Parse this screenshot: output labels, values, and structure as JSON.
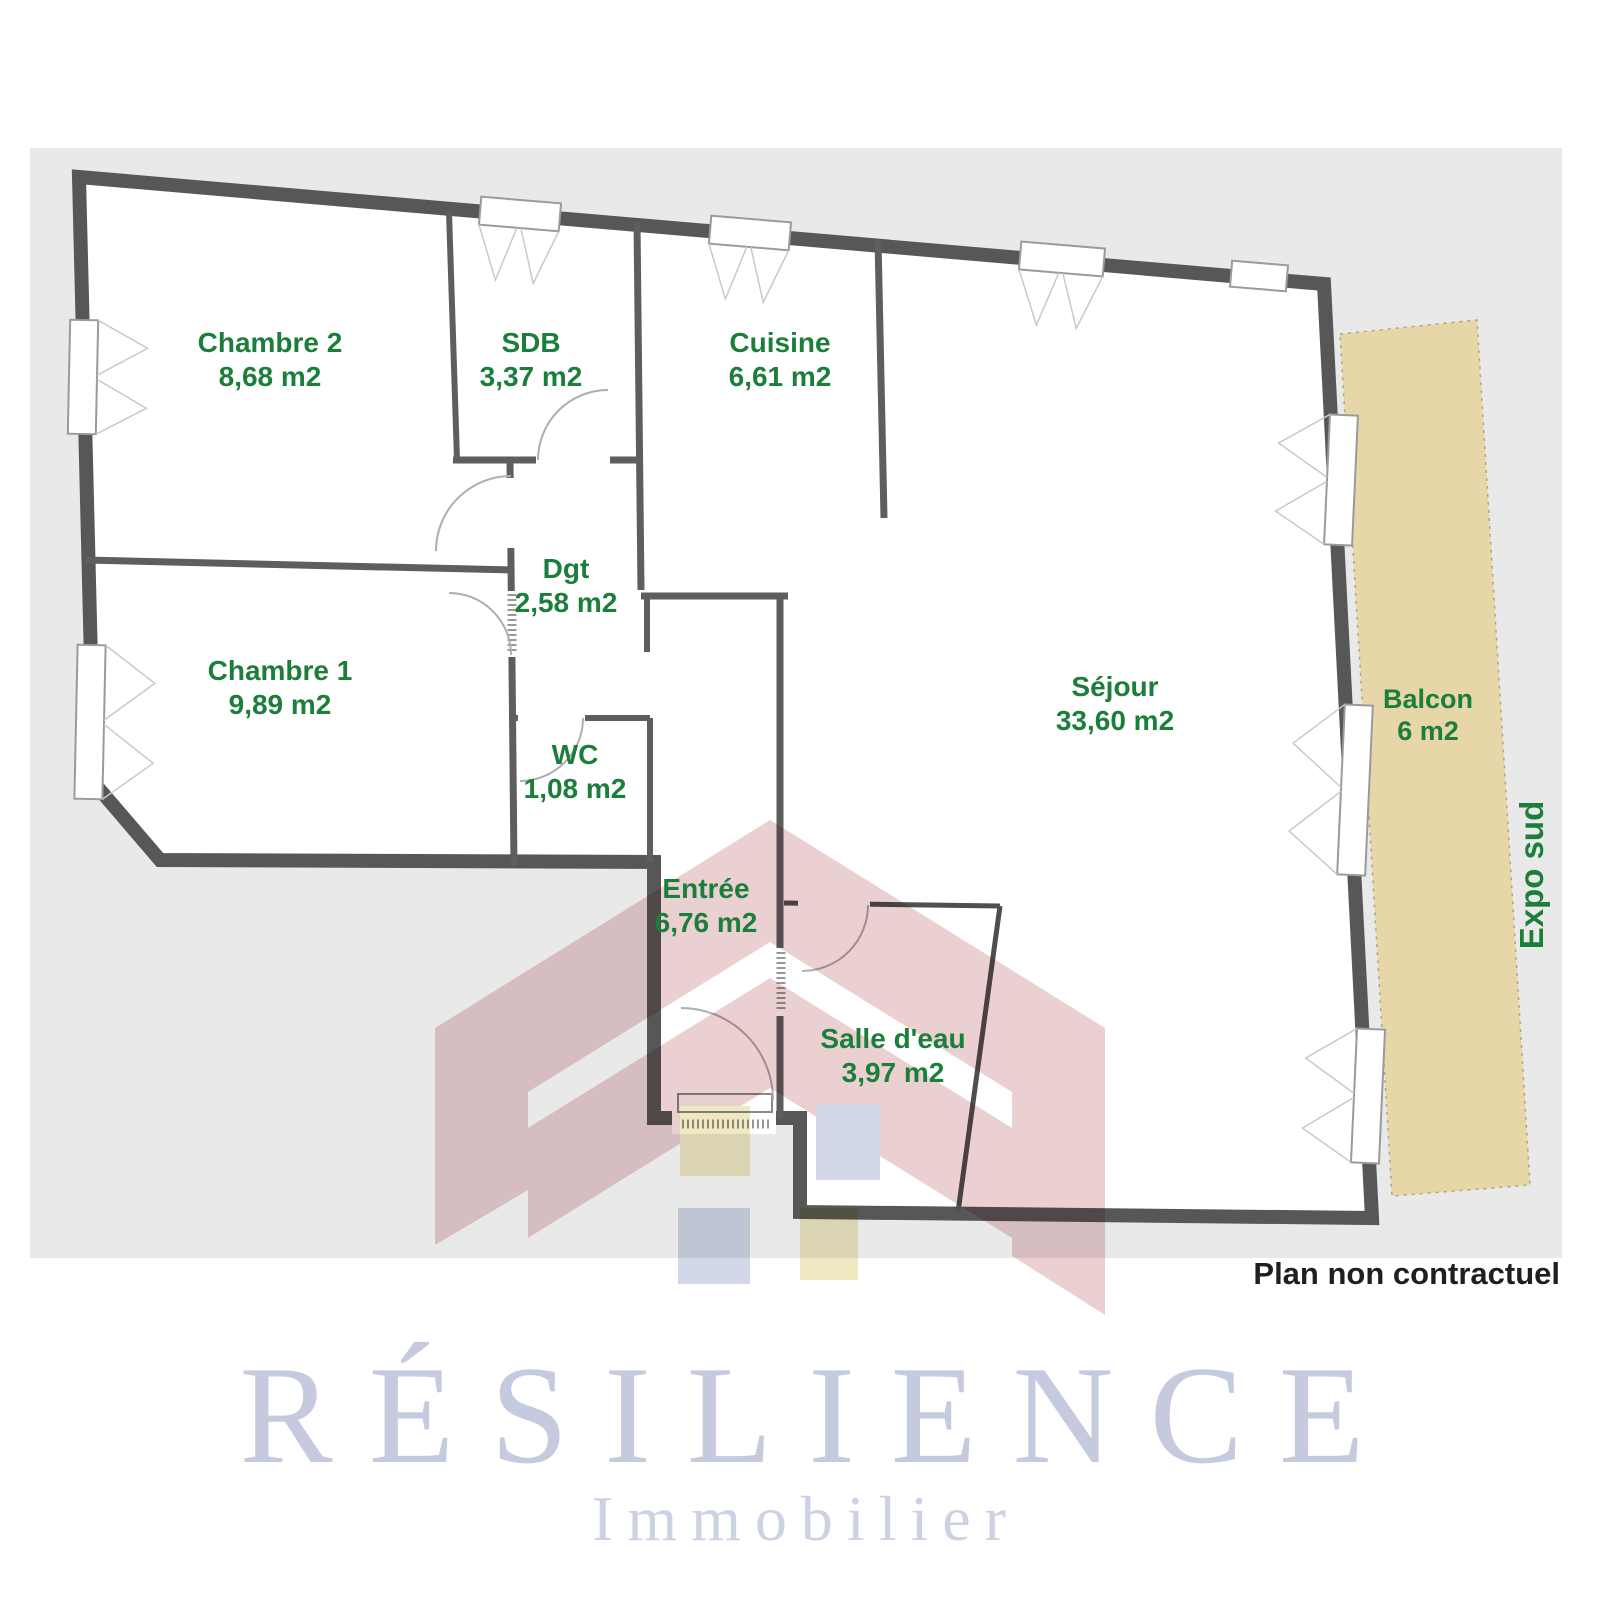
{
  "plan": {
    "background_color": "#e9e9e9",
    "wall_color": "#575757",
    "label_color": "#1b7e3b",
    "balcony_color": "#e7d6a8",
    "disclaimer": "Plan non contractuel",
    "exposure_label": "Expo sud",
    "rooms": [
      {
        "name": "Chambre 2",
        "area": "8,68 m2"
      },
      {
        "name": "SDB",
        "area": "3,37 m2"
      },
      {
        "name": "Cuisine",
        "area": "6,61 m2"
      },
      {
        "name": "Dgt",
        "area": "2,58 m2"
      },
      {
        "name": "Chambre 1",
        "area": "9,89 m2"
      },
      {
        "name": "WC",
        "area": "1,08 m2"
      },
      {
        "name": "Séjour",
        "area": "33,60 m2"
      },
      {
        "name": "Entrée",
        "area": "6,76 m2"
      },
      {
        "name": "Salle d'eau",
        "area": "3,97 m2"
      },
      {
        "name": "Balcon",
        "area": "6 m2"
      }
    ]
  },
  "branding": {
    "brand": "RÉSILIENCE",
    "tagline": "Immobilier",
    "brand_color": "#c5cade"
  },
  "watermark": {
    "pink": "#cf8f92",
    "blue": "#94a2c8",
    "yellow": "#d8c76f"
  }
}
